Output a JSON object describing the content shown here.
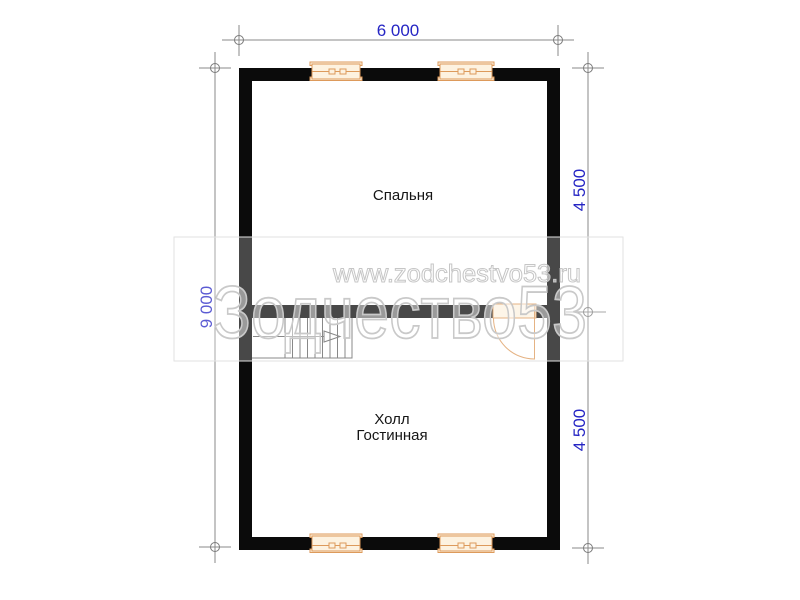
{
  "dimensions": {
    "top": "6 000",
    "left": "9 000",
    "right_top": "4 500",
    "right_bottom": "4 500",
    "text_color": "#2525c4"
  },
  "rooms": {
    "bedroom": "Спальня",
    "hall": "Холл",
    "living": "Гостинная"
  },
  "watermark": {
    "url": "www.zodchestvo53.ru",
    "brand": "Зодчество53"
  },
  "colors": {
    "wall": "#0b0b0b",
    "dimension_line": "#8a8a8a",
    "joinery_accent": "#dd9a5b",
    "joinery_fill": "#fdf2e0",
    "watermark_outline": "#c9c9c9"
  }
}
